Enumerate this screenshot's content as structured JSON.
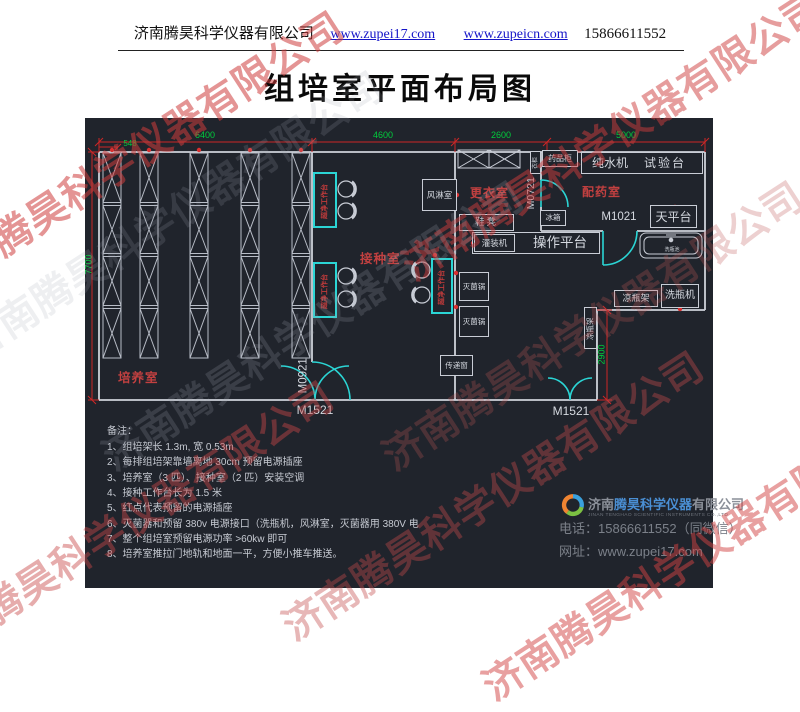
{
  "header": {
    "company": "济南腾昊科学仪器有限公司",
    "link1": "www.zupei17.com",
    "link2": "www.zupeicn.com",
    "phone": "15866611552"
  },
  "title": "组培室平面布局图",
  "plan": {
    "dims": {
      "d548": "548",
      "d6400": "6400",
      "d4600": "4600",
      "d2600": "2600",
      "d5000": "5000",
      "d7700": "7700",
      "d2900": "2900"
    },
    "rooms": {
      "culture": "培养室",
      "inoculation": "接种室",
      "air_shower": "风淋室",
      "changing": "更衣室",
      "dispensing": "配药室"
    },
    "doors": {
      "m0921": "M0921",
      "m0721": "M0721",
      "m1021": "M1021",
      "m1521": "M1521"
    },
    "equipment": {
      "clean_bench": "超净工作台",
      "medicine_cabinet": "药品柜",
      "wardrobe": "衣柜",
      "pure_water": "纯水机",
      "test_bench": "试验台",
      "shoe_bench": "鞋凳",
      "fridge": "冰箱",
      "balance_table": "天平台",
      "filling_machine": "灌装机",
      "operation_platform": "操作平台",
      "wash_sink": "洗瓶池",
      "sterilizer": "灭菌锅",
      "pass_window": "传递窗",
      "cooling_rack": "凉瓶架",
      "bottle_washer": "洗瓶机"
    }
  },
  "notes": {
    "heading": "备注：",
    "items": [
      "1、组培架长 1.3m, 宽 0.53m",
      "2、每排组培架靠墙离地 30cm 预留电源插座",
      "3、培养室（3 匹）、接种室（2 匹）安装空调",
      "4、接种工作台长为 1.5 米",
      "5、红点代表预留的电源插座",
      "6、灭菌器和预留 380v 电源接口（洗瓶机，风淋室，灭菌器用 380V 电",
      "7、整个组培室预留电源功率 >60kw 即可",
      "8、培养室推拉门地轨和地面一平，方便小推车推送。"
    ]
  },
  "footer": {
    "company_prefix": "济南",
    "company_brand": "腾昊科学仪器",
    "company_suffix": "有限公司",
    "company_en": "JINAN TENGHAO SCIENTIFIC INSTRUMENTS CO.,LTD",
    "phone": "电话：15866611552（同微信）",
    "website": "网址：www.zupei17.com"
  },
  "watermark": "济南腾昊科学仪器有限公司"
}
